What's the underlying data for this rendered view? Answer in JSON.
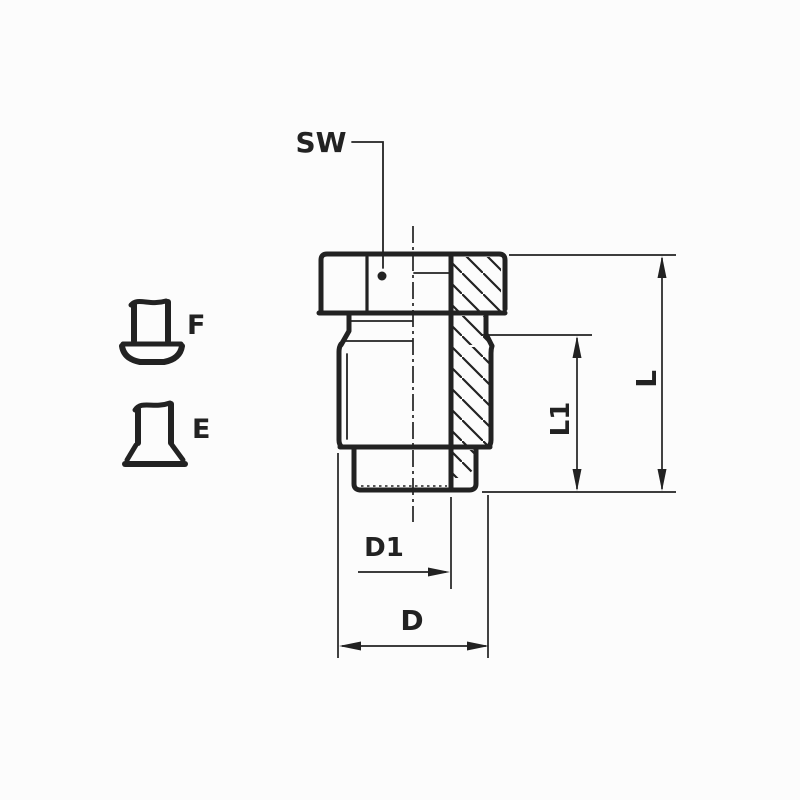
{
  "drawing": {
    "type": "technical-drawing",
    "description": "Sectioned hex-head threaded plug fitting with dimension callouts and seal form symbols",
    "labels": {
      "sw": "SW",
      "f": "F",
      "e": "E",
      "l": "L",
      "l1": "L1",
      "d1": "D1",
      "d": "D"
    },
    "colors": {
      "line": "#222222",
      "background": "#fcfcfc"
    }
  }
}
